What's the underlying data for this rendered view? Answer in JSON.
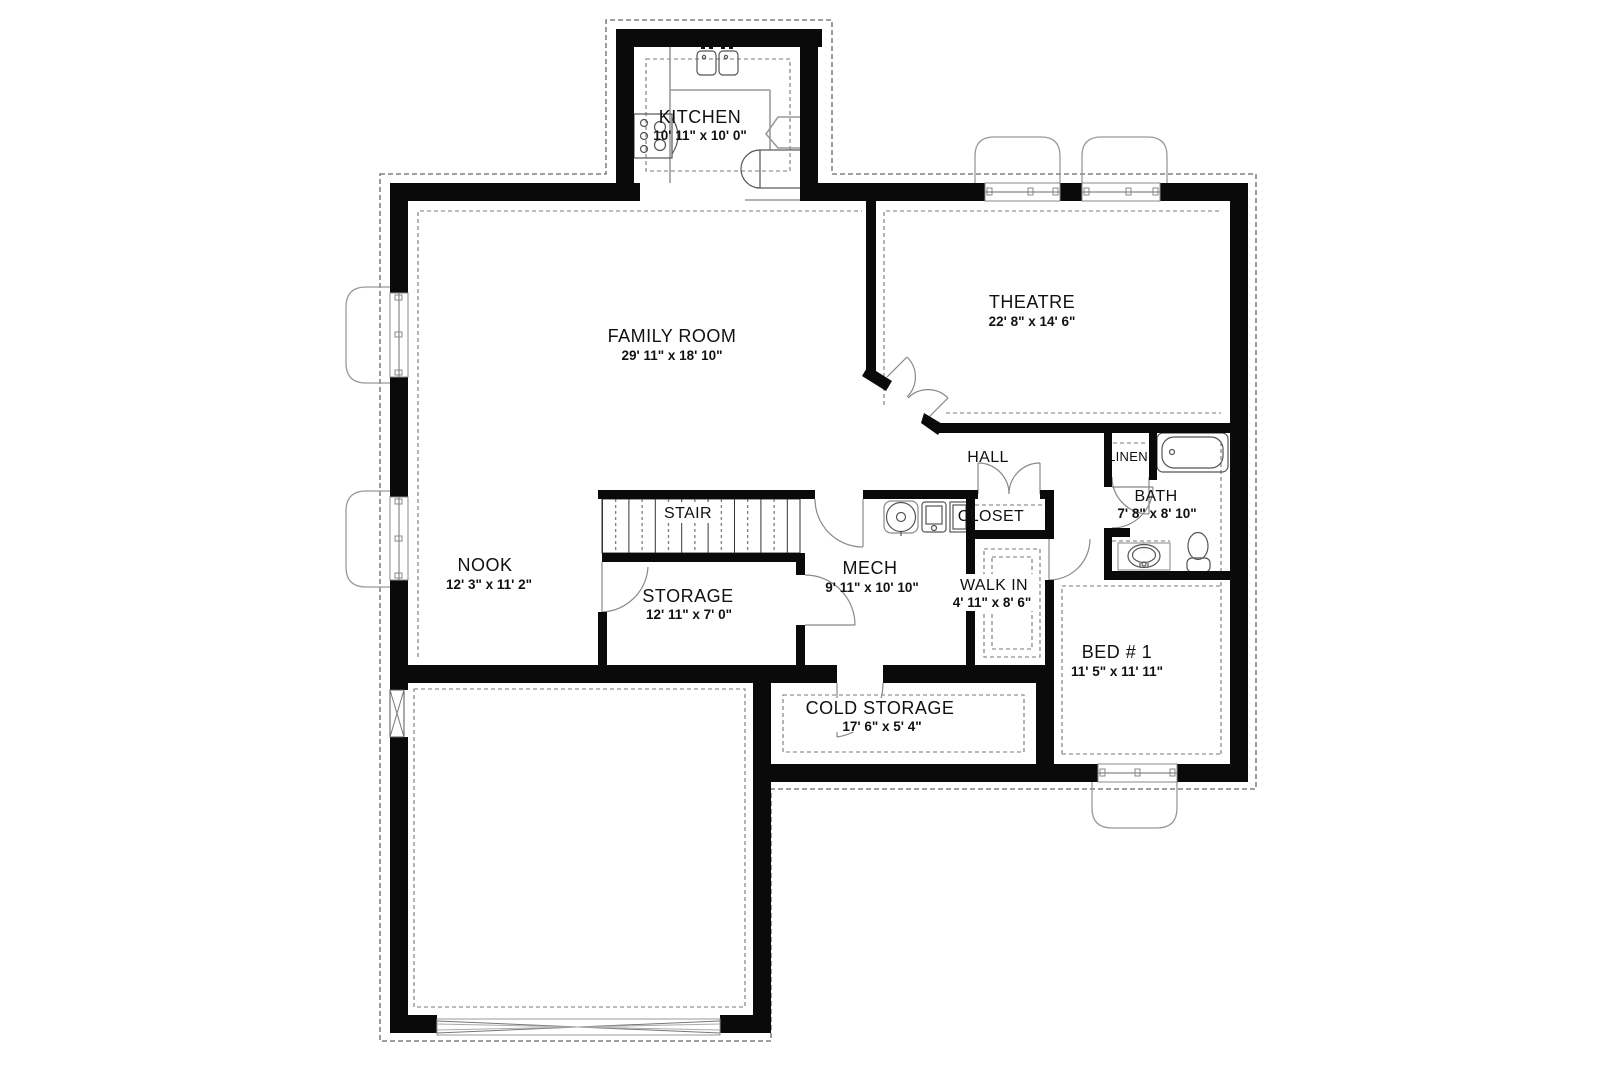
{
  "rooms": {
    "kitchen": {
      "name": "KITCHEN",
      "dims": "10' 11\" x 10' 0\""
    },
    "family_room": {
      "name": "FAMILY ROOM",
      "dims": "29' 11\" x 18' 10\""
    },
    "theatre": {
      "name": "THEATRE",
      "dims": "22' 8\" x 14' 6\""
    },
    "hall": {
      "name": "HALL"
    },
    "linen": {
      "name": "LINEN"
    },
    "bath": {
      "name": "BATH",
      "dims": "7' 8\" x 8' 10\""
    },
    "closet": {
      "name": "CLOSET"
    },
    "stair": {
      "name": "STAIR"
    },
    "nook": {
      "name": "NOOK",
      "dims": "12' 3\" x 11' 2\""
    },
    "mech": {
      "name": "MECH",
      "dims": "9' 11\" x 10' 10\""
    },
    "storage": {
      "name": "STORAGE",
      "dims": "12' 11\" x 7' 0\""
    },
    "walk_in": {
      "name": "WALK IN",
      "dims": "4' 11\" x 8' 6\""
    },
    "bed1": {
      "name": "BED # 1",
      "dims": "11' 5\" x 11' 11\""
    },
    "cold_storage": {
      "name": "COLD STORAGE",
      "dims": "17' 6\" x 5' 4\""
    }
  },
  "colors": {
    "wall": "#0a0a0a",
    "fixture_line": "#8a8a8a",
    "dashed_line": "#666666",
    "background": "#ffffff"
  }
}
